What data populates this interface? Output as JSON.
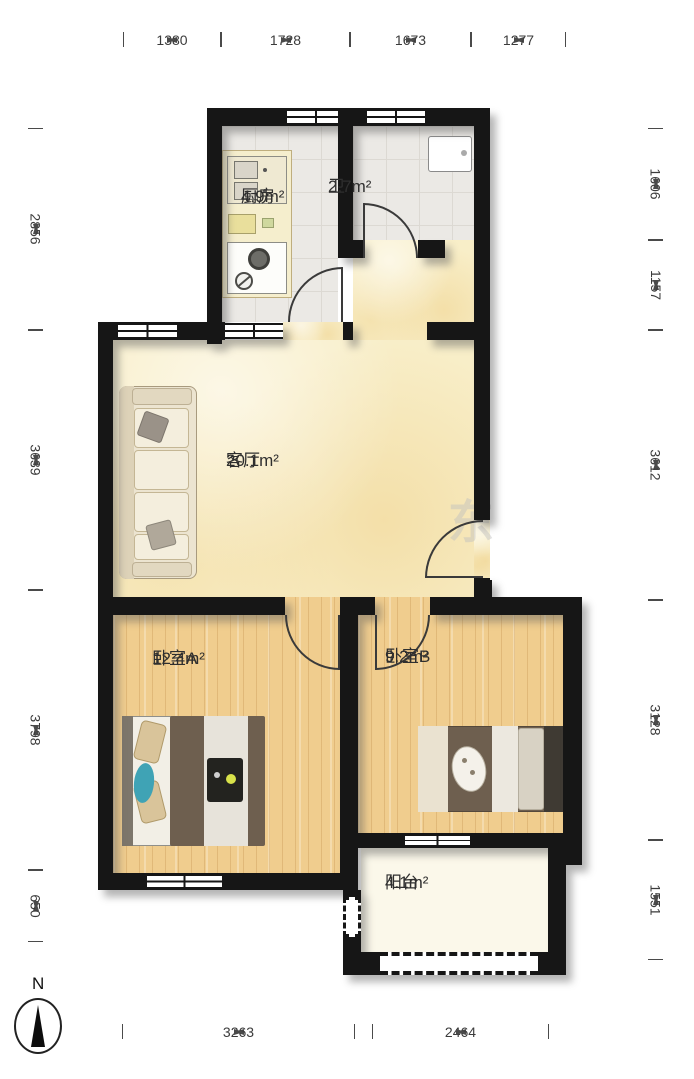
{
  "plan": {
    "rooms": [
      {
        "id": "kitchen",
        "name": "厨房",
        "area": "4.9m²"
      },
      {
        "id": "bath",
        "name": "卫",
        "area": "2.7m²"
      },
      {
        "id": "living",
        "name": "客厅",
        "area": "20.1m²"
      },
      {
        "id": "bedroomA",
        "name": "卧室A",
        "area": "12.4m²"
      },
      {
        "id": "bedroomB",
        "name": "卧室B",
        "area": "9.2m²"
      },
      {
        "id": "balcony",
        "name": "阳台",
        "area": "4.1m²"
      }
    ],
    "watermark": "东"
  },
  "dimensions": {
    "top": [
      "1380",
      "1728",
      "1673",
      "1277"
    ],
    "left": [
      "2856",
      "3639",
      "3798",
      "650"
    ],
    "right": [
      "1606",
      "1157",
      "3612",
      "3128",
      "1551"
    ],
    "bottom": [
      "3263",
      "2464"
    ]
  },
  "compass": {
    "label": "N"
  },
  "colors": {
    "wall": "#161616",
    "living_floor": "#f8eec8",
    "bedroom_floor": "#f0cd8e",
    "tile_floor": "#ebe9e5",
    "balcony_floor": "#fbf8ea",
    "dimension_text": "#3b3b3b"
  }
}
